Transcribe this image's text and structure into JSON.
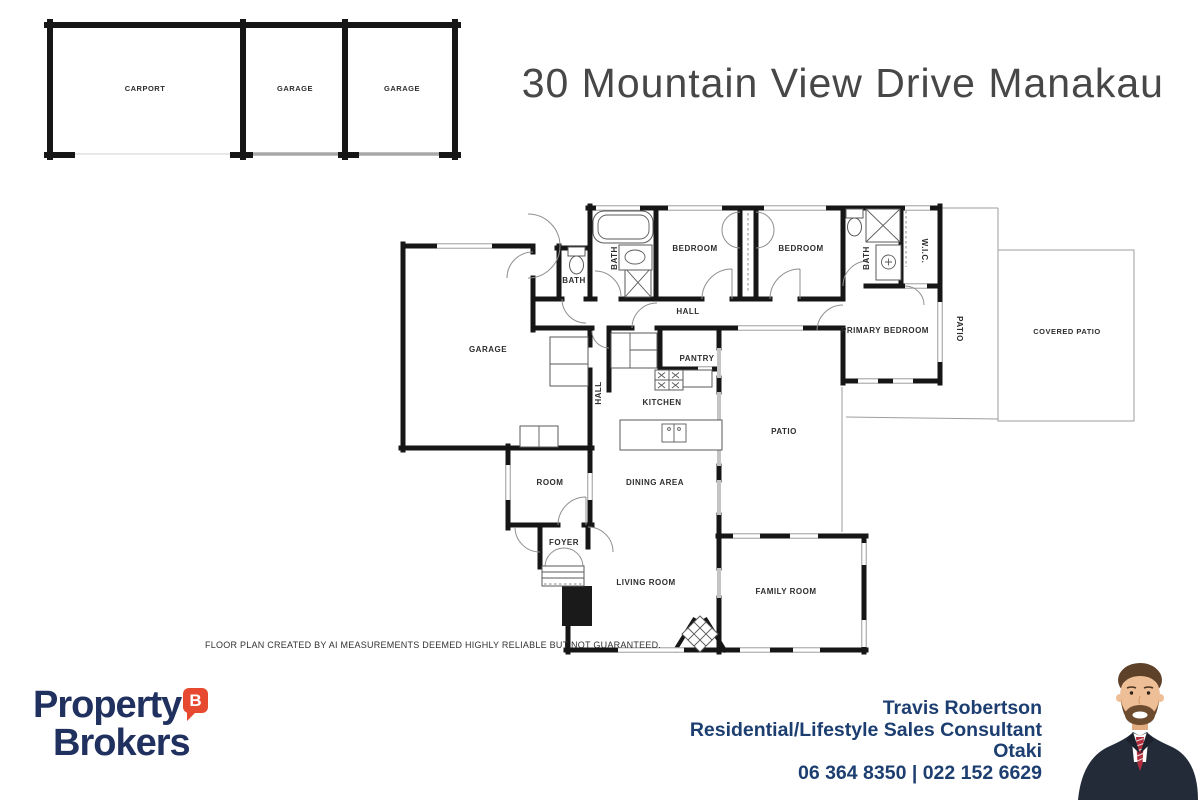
{
  "title": "30 Mountain View Drive Manakau",
  "disclaimer": "FLOOR PLAN CREATED BY AI MEASUREMENTS DEEMED HIGHLY RELIABLE BUT NOT GUARANTEED.",
  "colors": {
    "brand_navy": "#20305f",
    "brand_red": "#e64830",
    "agent_text": "#1c3e70",
    "wall_black": "#161616",
    "title_gray": "#474747"
  },
  "logo": {
    "word1": "Property",
    "word2": "Brokers",
    "bubble_letter": "B"
  },
  "agent": {
    "name": "Travis Robertson",
    "role": "Residential/Lifestyle Sales Consultant",
    "location": "Otaki",
    "phone": "06 364 8350 | 022 152 6629"
  },
  "floorplan": {
    "outbuilding": {
      "carport": "CARPORT",
      "garage_left": "GARAGE",
      "garage_right": "GARAGE"
    },
    "rooms": {
      "bath_small": "BATH",
      "bath_main": "BATH",
      "bedroom_1": "BEDROOM",
      "bedroom_2": "BEDROOM",
      "bath_ensuite": "BATH",
      "wic": "W.I.C.",
      "hall": "HALL",
      "hall_small": "HALL",
      "primary_bedroom": "PRIMARY BEDROOM",
      "patio_side": "PATIO",
      "covered_patio": "COVERED PATIO",
      "garage": "GARAGE",
      "pantry": "PANTRY",
      "kitchen": "KITCHEN",
      "patio": "PATIO",
      "room": "ROOM",
      "dining_area": "DINING AREA",
      "foyer": "FOYER",
      "living_room": "LIVING ROOM",
      "family_room": "FAMILY ROOM"
    }
  }
}
